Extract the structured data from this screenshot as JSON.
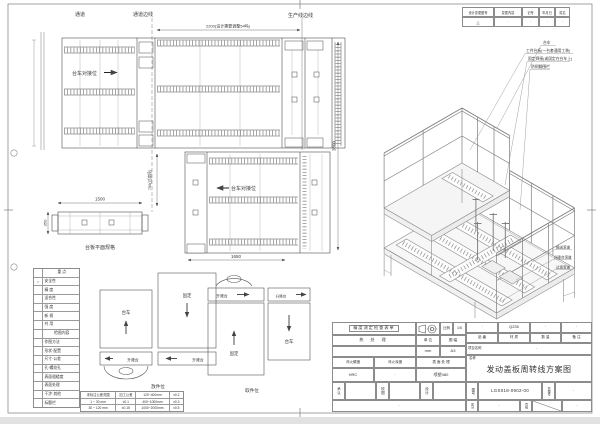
{
  "sheet": {
    "bg": "#ffffff",
    "line_color": "#4d4d4d",
    "frame_color": "#8c8c8c"
  },
  "revision": {
    "headers": [
      "设计变更图号",
      "变更内容",
      "记号",
      "年月日",
      "姓名"
    ],
    "values": [
      "△",
      "·",
      "·",
      "·",
      "·"
    ]
  },
  "plan": {
    "aisle": "通道",
    "aisle_edge": "通道边线",
    "prod_edge": "生产线边线",
    "dock_label_1": "台车对接位",
    "dock_label_2": "台车对接位",
    "dim_2200": "2200(设计需要调整54吗)",
    "dim_1500": "1500",
    "dim_750": "750(过渡段)",
    "dim_350": "350",
    "dim_1650": "1650",
    "dim_3800": "3800",
    "side_view_label": "台板平面规格"
  },
  "positions": {
    "left_label": "放件位",
    "right_label": "取件位",
    "trolley": "台车",
    "fixed": "固定",
    "lift": "升降台"
  },
  "iso": {
    "callouts_top": [
      "台车",
      "工件台板(一台套通用工装)",
      "固定焊接(或固定在台车上)",
      "防侧翻围栏"
    ],
    "callouts_right": [
      "输送滚道",
      "升降台滚道",
      "过渡滚道"
    ]
  },
  "checklist": {
    "rows": [
      {
        "mark": "",
        "label": "重  点"
      },
      {
        "mark": "○",
        "label": "安全性"
      },
      {
        "mark": "",
        "label": "精 度"
      },
      {
        "mark": "",
        "label": "适合性"
      },
      {
        "mark": "",
        "label": "强 度"
      },
      {
        "mark": "",
        "label": "新 规"
      },
      {
        "mark": "",
        "label": "共 用"
      },
      {
        "mark": "",
        "label": "检图内容"
      },
      {
        "mark": "",
        "label": "作图方法"
      },
      {
        "mark": "",
        "label": "形状·配置"
      },
      {
        "mark": "",
        "label": "尺寸·公差"
      },
      {
        "mark": "",
        "label": "孔·螺纹孔"
      },
      {
        "mark": "",
        "label": "表面粗糙度"
      },
      {
        "mark": "",
        "label": "表面处理"
      },
      {
        "mark": "",
        "label": "干涉·其他"
      },
      {
        "mark": "",
        "label": "标题栏"
      }
    ]
  },
  "tolerance": {
    "rows": [
      [
        "未标注公差范围",
        "加工公差",
        "120~400mm",
        "±0.2"
      ],
      [
        "1 ~ 30 mm",
        "±0.1",
        "400~1000mm",
        "±0.3"
      ],
      [
        "30 ~ 120 mm",
        "±0.15",
        "1000~2000mm",
        "±0.5"
      ]
    ]
  },
  "titleblock": {
    "inspect": "精度测定检查表单",
    "scale_label": "比例",
    "scale_value": "1/5",
    "heat_label": "热 处 理",
    "unit_label": "单 位",
    "unit_value": "mm",
    "format_label": "图 幅",
    "format_value": "A3",
    "part_label": "品 番",
    "part_value": "·",
    "material_label": "材 质",
    "material_value": "Q235",
    "qty_label": "数 量",
    "qty_value": "·",
    "remark_label": "备 注",
    "remark_value": "·",
    "project_label": "项目名称",
    "project_value": "·",
    "name_label": "名称",
    "title": "发动盖板周转线方案图",
    "hard_label": "淬火硬度",
    "hard_value": "HRC",
    "depth_label": "淬火深度",
    "depth_value": "·",
    "surface_label": "表 面 处 理",
    "surface_value": "喷塑480",
    "approve_label": "承认",
    "check_label": "校图",
    "design_label": "设计",
    "drawno_label": "图号",
    "drawno_value": "LGS018-0902-00",
    "manage_label": "管理号",
    "manage_value": "·",
    "class_label": "区分",
    "class_value": "·",
    "page_label": "页码",
    "footer_dot": "·"
  }
}
